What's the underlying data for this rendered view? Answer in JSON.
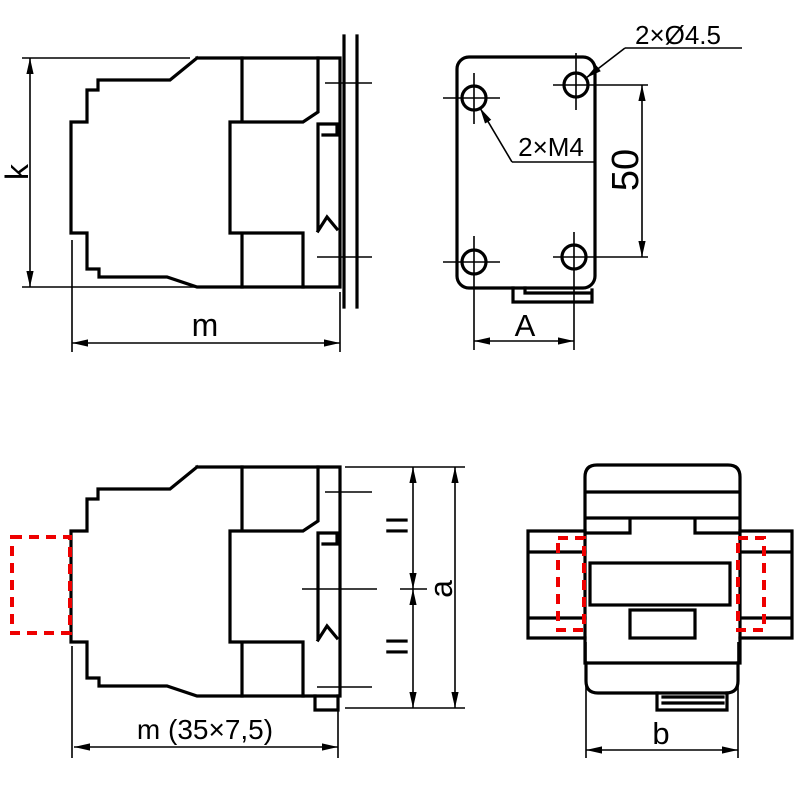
{
  "colors": {
    "ink": "#000000",
    "accent_red": "#ee0000",
    "background": "#ffffff"
  },
  "labels": {
    "side_upper": {
      "height": "k",
      "width": "m"
    },
    "rear": {
      "clearance_holes": "2×Ø4.5",
      "tapped_holes": "2×M4",
      "hole_spacing": "50",
      "hole_row_width": "A"
    },
    "side_lower": {
      "equal_upper": "=",
      "equal_lower": "=",
      "height": "a",
      "width": "m (35×7,5)"
    },
    "top": {
      "width": "b"
    }
  }
}
